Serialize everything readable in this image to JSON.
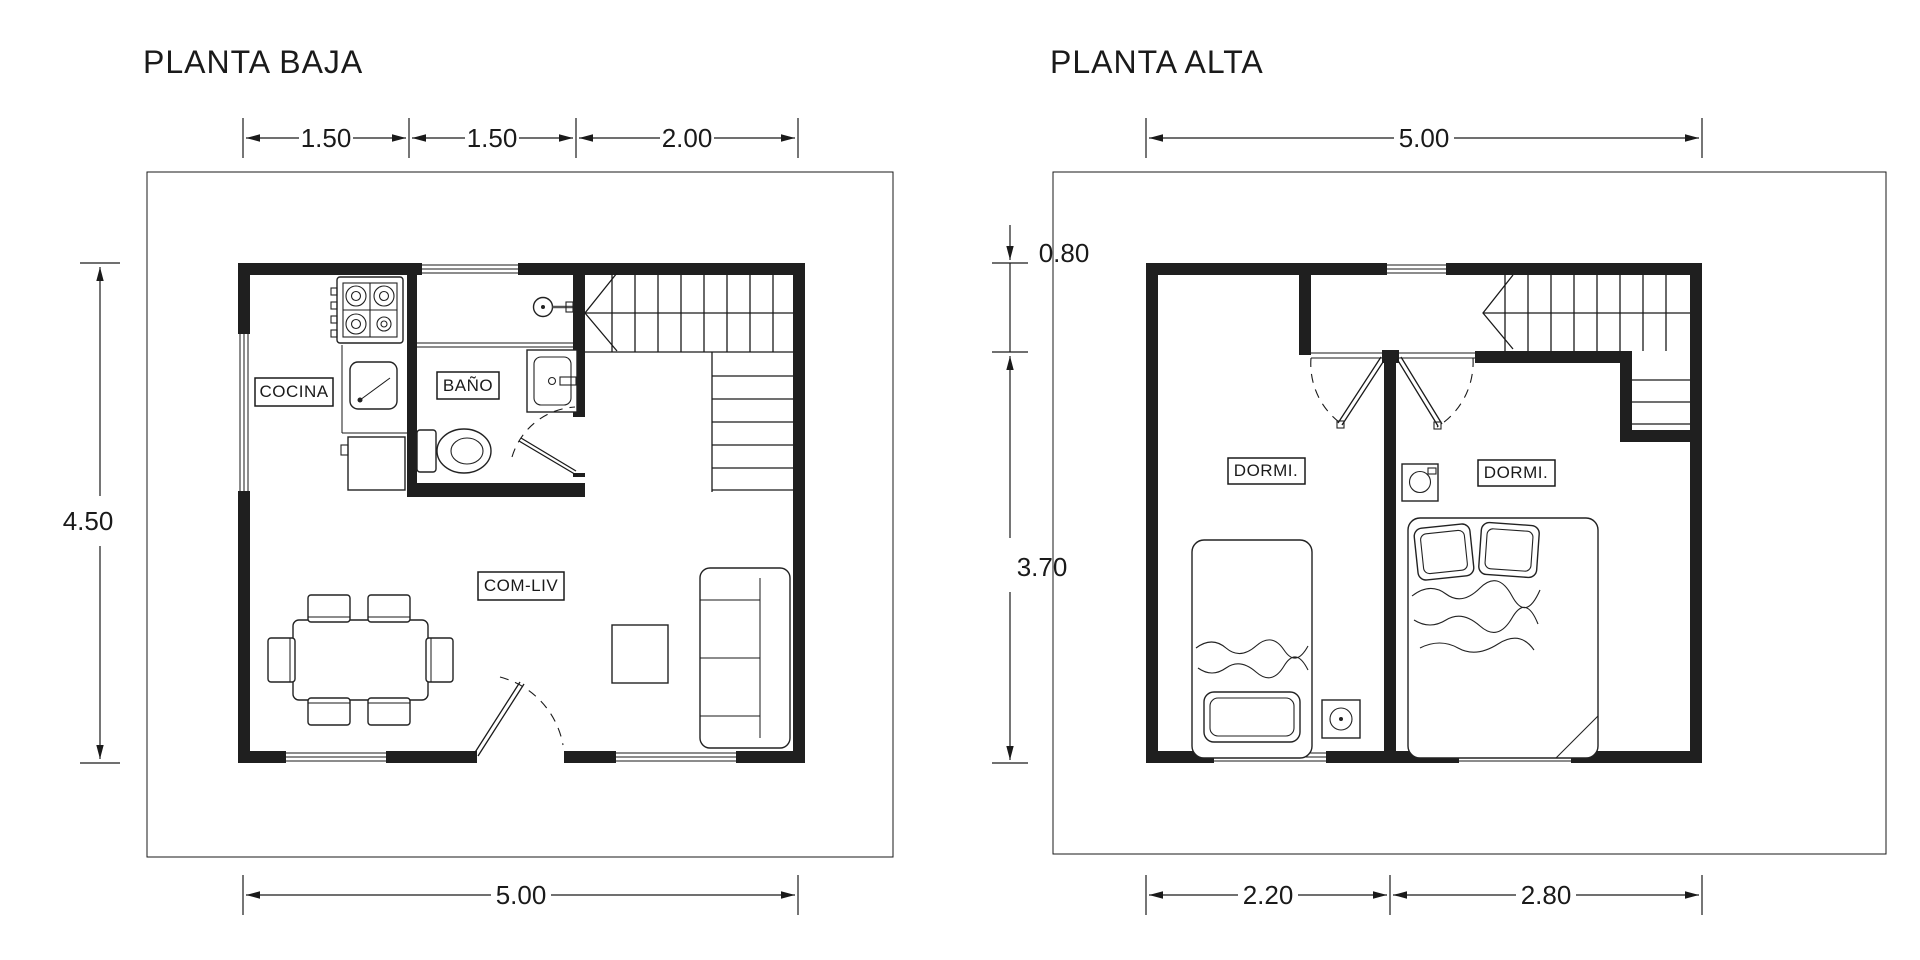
{
  "colors": {
    "ink": "#1a1a1a",
    "wall": "#1f1f1f",
    "paper": "#ffffff"
  },
  "planta_baja": {
    "title": "PLANTA BAJA",
    "room_labels": {
      "kitchen": "COCINA",
      "bathroom": "BAÑO",
      "living": "COM-LIV"
    },
    "dimensions": {
      "top": [
        "1.50",
        "1.50",
        "2.00"
      ],
      "left": "4.50",
      "bottom": "5.00"
    }
  },
  "planta_alta": {
    "title": "PLANTA ALTA",
    "room_labels": {
      "bedroom_left": "DORMI.",
      "bedroom_right": "DORMI."
    },
    "dimensions": {
      "top": "5.00",
      "left_upper": "0.80",
      "left_lower": "3.70",
      "bottom": [
        "2.20",
        "2.80"
      ]
    }
  }
}
